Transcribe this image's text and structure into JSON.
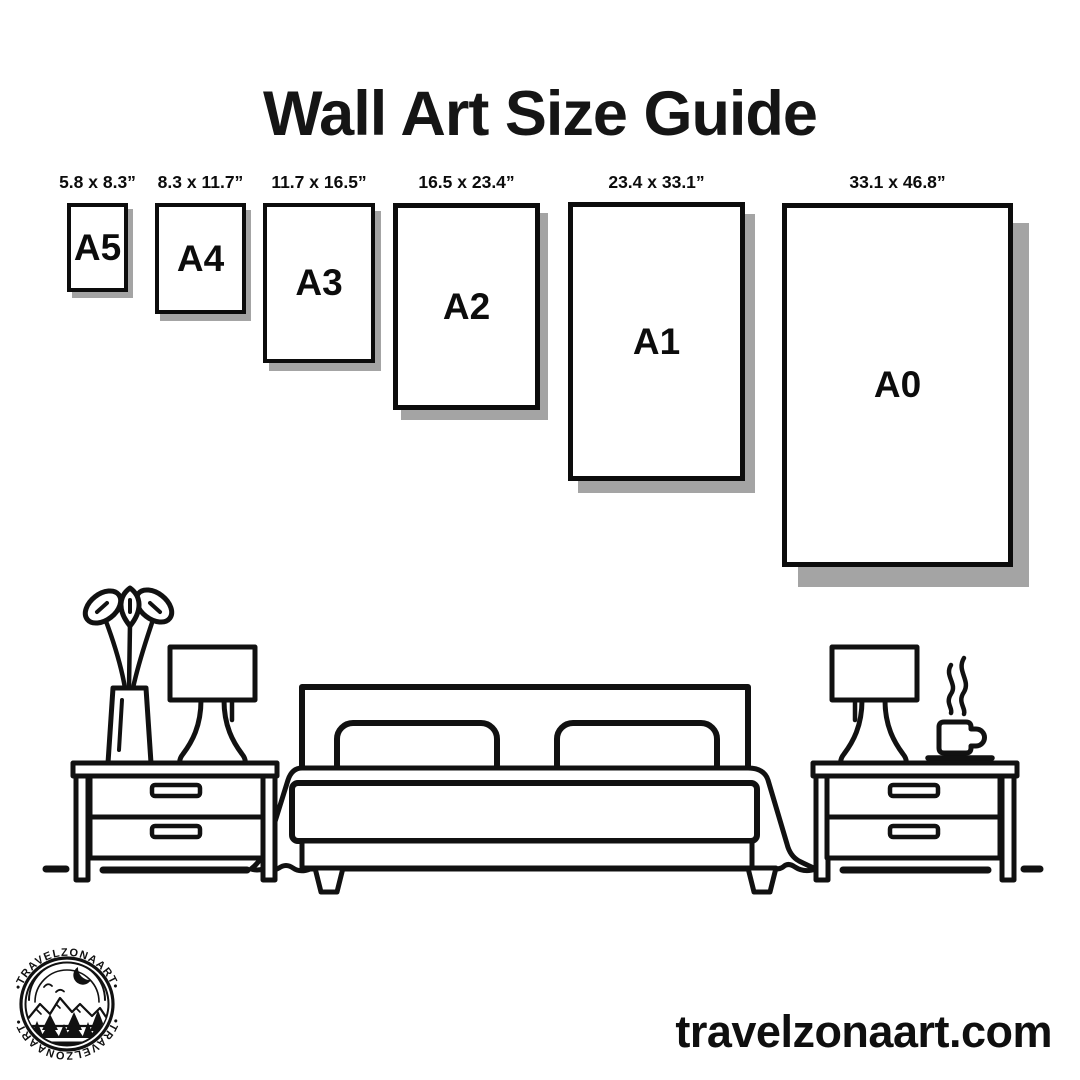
{
  "title": "Wall Art Size Guide",
  "website": "travelzonaart.com",
  "logo": {
    "brand_top": "•TRAVELZONAART•",
    "brand_bottom": "•TRAVELZONAART•",
    "motifs": [
      "crescent-moon",
      "birds",
      "mountains",
      "pine-trees",
      "lake"
    ]
  },
  "sizes": [
    {
      "code": "A5",
      "dimensions": "5.8 x 8.3”"
    },
    {
      "code": "A4",
      "dimensions": "8.3 x 11.7”"
    },
    {
      "code": "A3",
      "dimensions": "11.7 x 16.5”"
    },
    {
      "code": "A2",
      "dimensions": "16.5 x 23.4”"
    },
    {
      "code": "A1",
      "dimensions": "23.4 x 33.1”"
    },
    {
      "code": "A0",
      "dimensions": "33.1 x 46.8”"
    }
  ],
  "scene_icons": [
    "potted-plant-icon",
    "table-lamp-icon",
    "nightstand-icon",
    "double-bed-icon",
    "coffee-cup-icon"
  ],
  "colors": {
    "ink": "#111111",
    "paper_border": "#0c0c0c",
    "shadow": "#a4a4a4",
    "background": "#ffffff"
  }
}
